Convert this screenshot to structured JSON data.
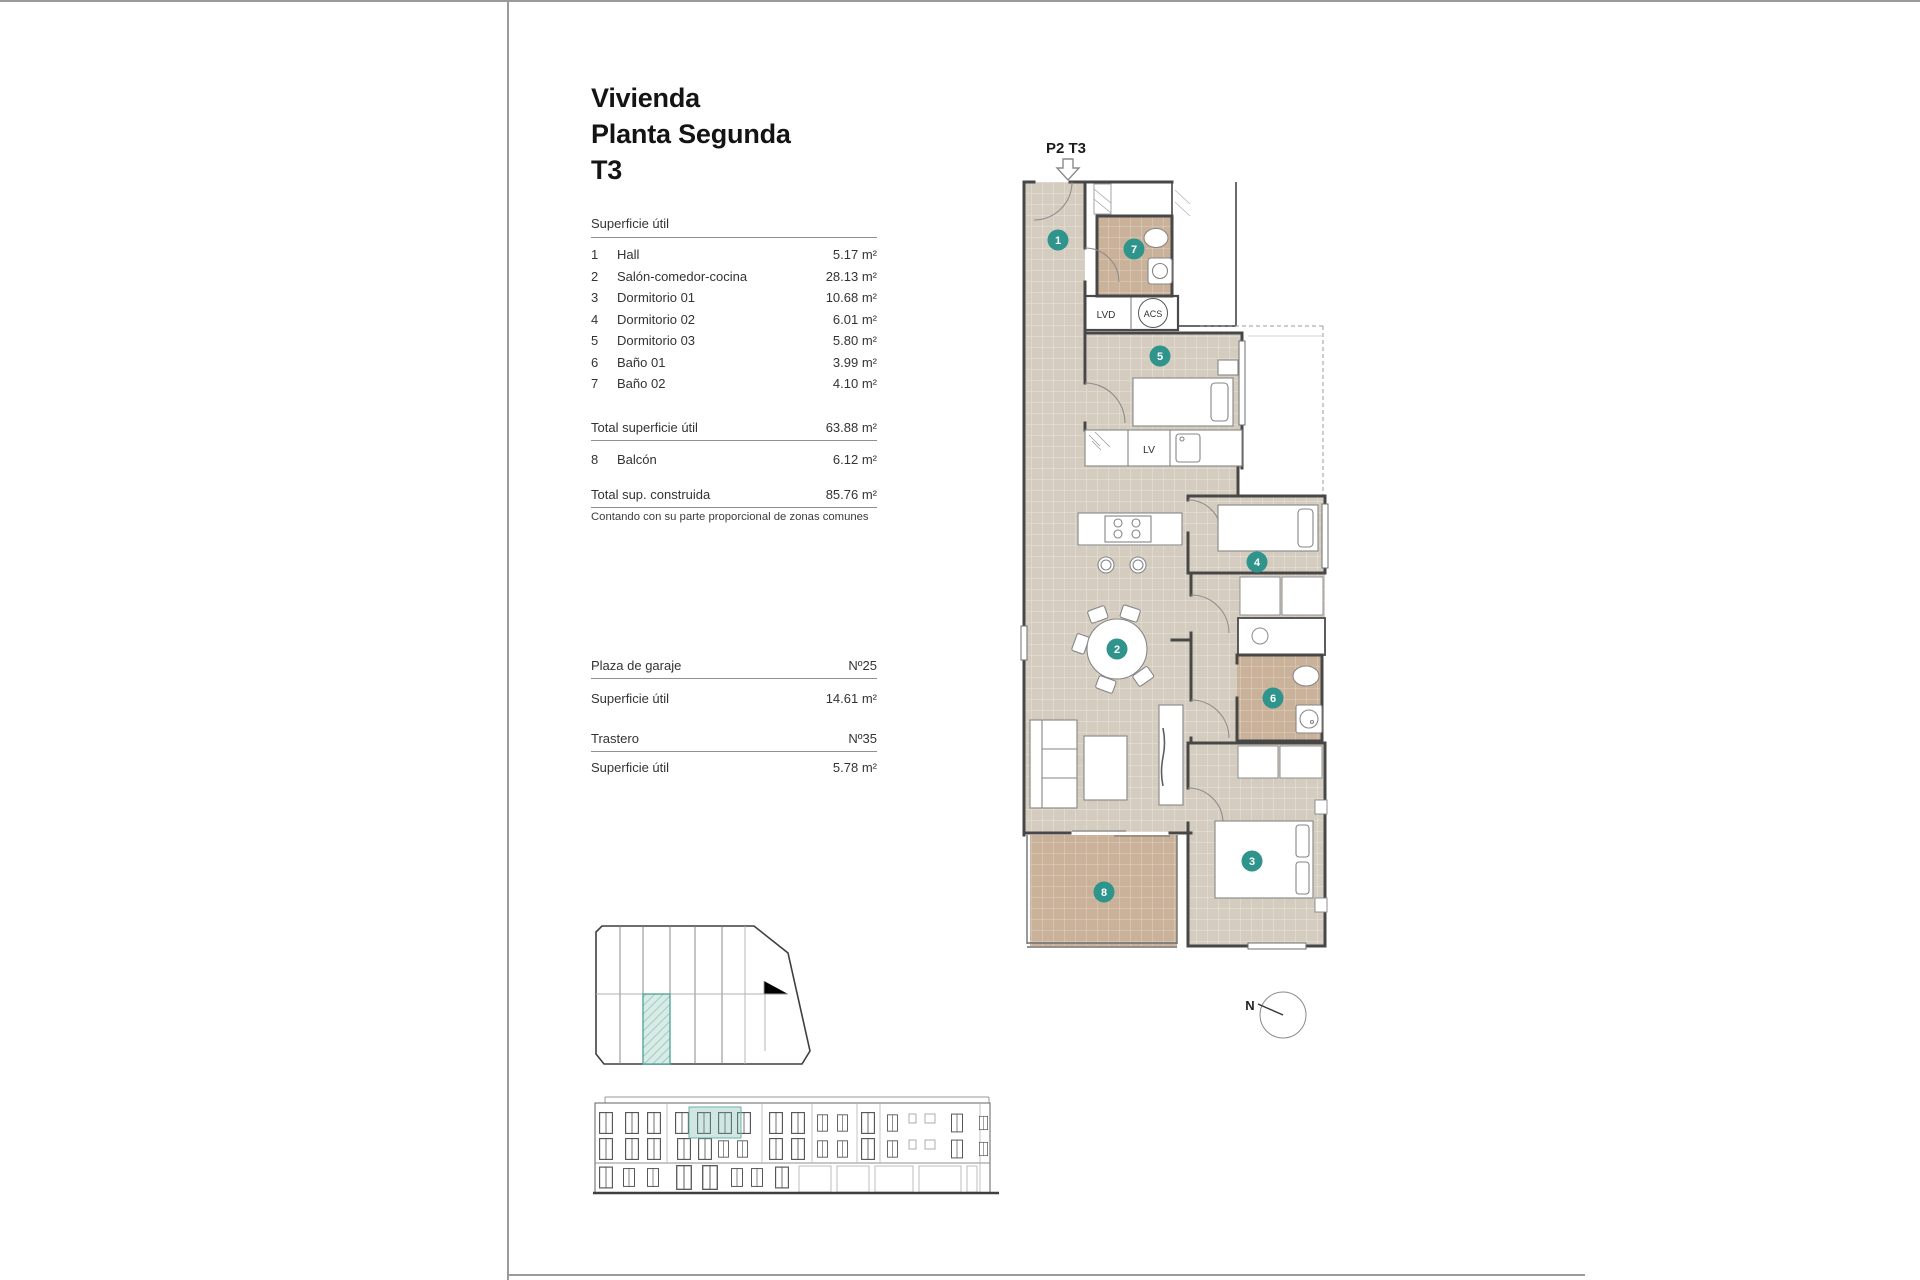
{
  "title": {
    "lines": [
      "Vivienda",
      "Planta Segunda",
      "T3"
    ]
  },
  "surface_table": {
    "header": "Superficie útil",
    "rows": [
      {
        "num": "1",
        "name": "Hall",
        "value": "5.17 m²"
      },
      {
        "num": "2",
        "name": "Salón-comedor-cocina",
        "value": "28.13 m²"
      },
      {
        "num": "3",
        "name": "Dormitorio 01",
        "value": "10.68 m²"
      },
      {
        "num": "4",
        "name": "Dormitorio 02",
        "value": "6.01 m²"
      },
      {
        "num": "5",
        "name": "Dormitorio 03",
        "value": "5.80 m²"
      },
      {
        "num": "6",
        "name": "Baño 01",
        "value": "3.99 m²"
      },
      {
        "num": "7",
        "name": "Baño 02",
        "value": "4.10 m²"
      }
    ],
    "total_label": "Total superficie útil",
    "total_value": "63.88 m²",
    "balcony": {
      "num": "8",
      "name": "Balcón",
      "value": "6.12 m²"
    },
    "built_label": "Total sup. construida",
    "built_value": "85.76 m²",
    "note": "Contando con su parte proporcional de zonas comunes"
  },
  "annex": {
    "garage_label": "Plaza de garaje",
    "garage_number": "Nº25",
    "garage_area_label": "Superficie útil",
    "garage_area_value": "14.61 m²",
    "storage_label": "Trastero",
    "storage_number": "Nº35",
    "storage_area_label": "Superficie útil",
    "storage_area_value": "5.78 m²"
  },
  "plan": {
    "unit_label": "P2 T3",
    "markers": [
      "1",
      "2",
      "3",
      "4",
      "5",
      "6",
      "7",
      "8"
    ],
    "labels": {
      "lvd": "LVD",
      "acs": "ACS",
      "lv": "LV"
    },
    "compass": "N",
    "colors": {
      "floor": "#d5ccc0",
      "wet": "#cab29a",
      "marker": "#2e948c",
      "highlight": "#bfded8"
    }
  }
}
